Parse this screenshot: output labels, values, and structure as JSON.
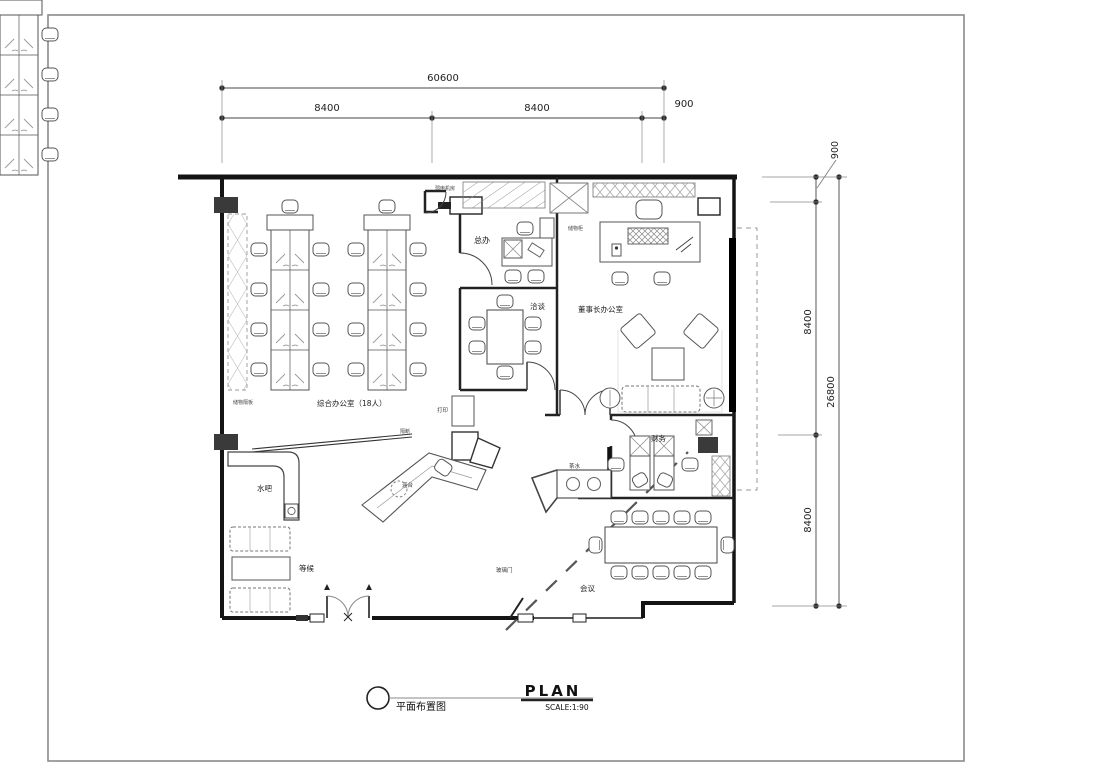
{
  "dims": {
    "top_total": "60600",
    "top_a": "8400",
    "top_b": "8400",
    "top_c": "900",
    "right_a": "900",
    "right_b": "8400",
    "right_total": "26800",
    "right_c": "8400"
  },
  "rooms": {
    "weak_current_room": "弱电机房",
    "general_manager": "总办",
    "storage_cabinet": "储物柜",
    "negotiation": "洽谈",
    "chairman_office": "董事长办公室",
    "open_office": "综合办公室（18人）",
    "storage_shelf": "储物隔板",
    "printer": "打印",
    "partition": "隔断",
    "reception": "迎台",
    "water_bar": "水吧",
    "waiting": "等候",
    "finance": "财务",
    "tea_water": "茶水",
    "meeting": "会议",
    "glass_door": "玻璃门"
  },
  "title_block": {
    "name": "平面布置图",
    "plan": "PLAN",
    "scale": "SCALE:1:90"
  }
}
